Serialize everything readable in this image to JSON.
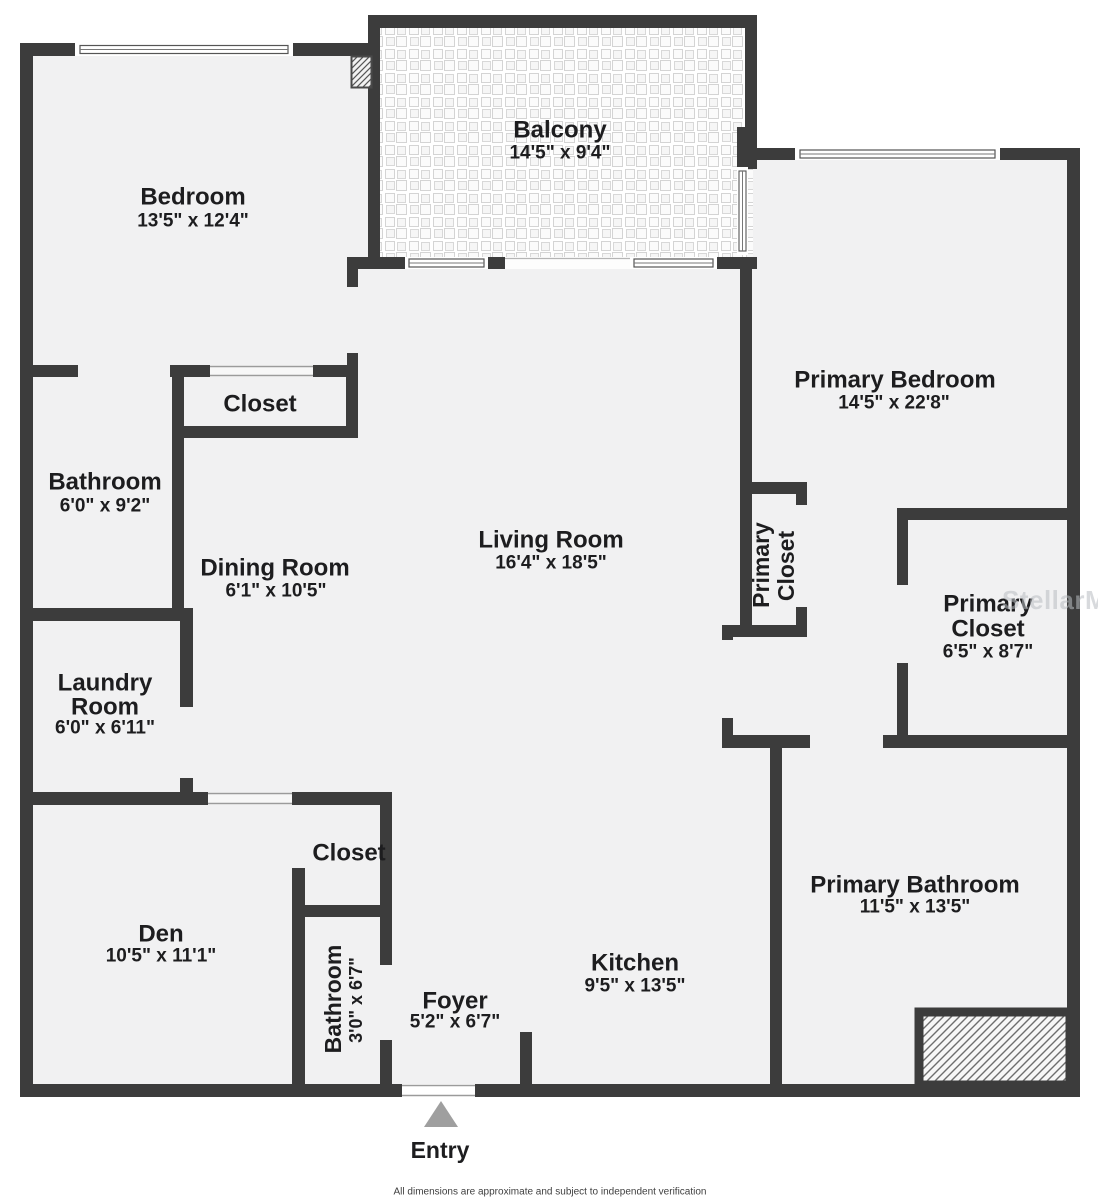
{
  "page": {
    "background": "#ffffff",
    "wall_color": "#3c3c3c",
    "floor_color": "#f1f1f2",
    "text_color": "#1d1d1f",
    "entry_arrow_color": "#9f9f9f",
    "watermark": "StellarMLS",
    "entry_label": "Entry",
    "disclaimer": "All dimensions are approximate and subject to independent verification"
  },
  "rooms": {
    "bedroom": {
      "name": "Bedroom",
      "dims": "13'5\" x 12'4\""
    },
    "balcony": {
      "name": "Balcony",
      "dims": "14'5\" x 9'4\""
    },
    "primary_bedroom": {
      "name": "Primary Bedroom",
      "dims": "14'5\" x 22'8\""
    },
    "closet_upper": {
      "name": "Closet"
    },
    "bathroom": {
      "name": "Bathroom",
      "dims": "6'0\" x 9'2\""
    },
    "dining_room": {
      "name": "Dining Room",
      "dims": "6'1\" x 10'5\""
    },
    "living_room": {
      "name": "Living Room",
      "dims": "16'4\" x 18'5\""
    },
    "primary_closet_hall": {
      "line1": "Primary",
      "line2": "Closet"
    },
    "primary_closet": {
      "line1": "Primary",
      "line2": "Closet",
      "dims": "6'5\" x 8'7\""
    },
    "laundry_room": {
      "line1": "Laundry",
      "line2": "Room",
      "dims": "6'0\" x 6'11\""
    },
    "den": {
      "name": "Den",
      "dims": "10'5\" x 11'1\""
    },
    "closet_lower": {
      "name": "Closet"
    },
    "bathroom_lower": {
      "name": "Bathroom",
      "dims": "3'0\" x 6'7\""
    },
    "foyer": {
      "name": "Foyer",
      "dims": "5'2\" x 6'7\""
    },
    "kitchen": {
      "name": "Kitchen",
      "dims": "9'5\" x 13'5\""
    },
    "primary_bathroom": {
      "name": "Primary Bathroom",
      "dims": "11'5\" x 13'5\""
    }
  }
}
